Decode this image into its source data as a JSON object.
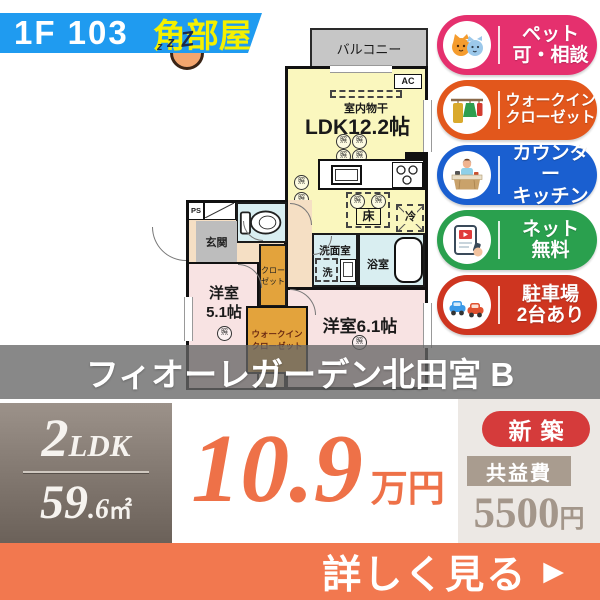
{
  "header": {
    "unit_label": "1F 103",
    "corner_label": "角部屋",
    "sleep_z_small": "z",
    "sleep_z_mid": "z",
    "sleep_z_large": "Z"
  },
  "floorplan": {
    "balcony": "バルコニー",
    "indoor_drying": "室内物干",
    "ldk_label": "LDK12.2帖",
    "ac_label": "AC",
    "light_label": "照",
    "floor_storage": "床",
    "fridge": "冷",
    "entrance": "玄関",
    "ps": "PS",
    "washroom": "洗面室",
    "washer": "洗",
    "bathroom": "浴室",
    "bedroom1_line1": "洋室",
    "bedroom1_line2": "5.1帖",
    "closet_line1": "クロー",
    "closet_line2": "ゼット",
    "wic_line1": "ウォークイン",
    "wic_line2": "クローゼット",
    "bedroom2_label": "洋室6.1帖"
  },
  "badges": [
    {
      "icon": "pets-icon",
      "line1": "ペット",
      "line2": "可・相談",
      "color": "#e5306e"
    },
    {
      "icon": "walkin-closet-icon",
      "line1": "ウォークイン",
      "line2": "クローゼット",
      "color": "#e2571c"
    },
    {
      "icon": "counter-kitchen-icon",
      "line1": "カウンター",
      "line2": "キッチン",
      "color": "#1a5fd0"
    },
    {
      "icon": "free-internet-icon",
      "line1": "ネット",
      "line2": "無料",
      "color": "#2aa04e"
    },
    {
      "icon": "parking-icon",
      "line1": "駐車場",
      "line2": "2台あり",
      "color": "#ce3520"
    }
  ],
  "property_name": "フィオーレガーデン北田宮 B",
  "spec": {
    "layout_num": "2",
    "layout_type": "LDK",
    "area_int": "59",
    "area_frac": ".6",
    "area_unit": "㎡"
  },
  "price": {
    "amount": "10.9",
    "unit": "万円"
  },
  "labels": {
    "new_build": "新築",
    "fee_label": "共益費",
    "fee_amount": "5500",
    "fee_unit": "円"
  },
  "cta": {
    "label": "詳しく見る",
    "arrow": "▶"
  },
  "colors": {
    "banner_blue": "#1f9bf0",
    "corner_yellow": "#f5f000",
    "price_orange": "#ee7148",
    "new_build_red": "#d53b3b",
    "fee_taupe": "#a99c8f",
    "cta_orange": "#f2784f",
    "name_overlay": "rgba(102,102,102,0.78)"
  }
}
